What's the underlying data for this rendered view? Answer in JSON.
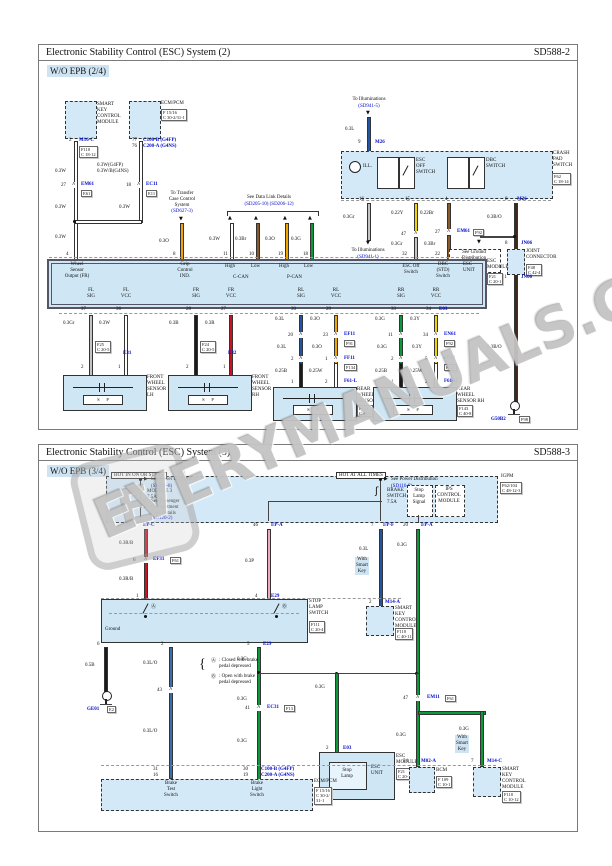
{
  "icons": {
    "fuse": "ʃ",
    "arrow_down": "▼",
    "arrow_up": "▲",
    "arrow_right": "▶",
    "chevron": "^",
    "brace": "{"
  },
  "watermark": {
    "text": "EVERYMANUALS.COM",
    "logo_letter": "E"
  },
  "colors": {
    "component_fill": "#d4e9f7",
    "module_fill": "#cfe7f5",
    "link_blue": "#0008c8",
    "wire_white": "#ffffff",
    "wire_gray": "#c4c4c4",
    "wire_black": "#1a1a1a",
    "wire_red": "#cc1122",
    "wire_blue": "#2055a8",
    "wire_blue_orange": "#3a6fae",
    "wire_green": "#0a9a3c",
    "wire_orange": "#f0a500",
    "wire_yellow": "#f2d500",
    "wire_brown": "#8a5a2a",
    "wire_dark_brown": "#40291a",
    "wire_pink": "#f2a9c4"
  },
  "p1": {
    "title": "Electronic Stability Control (ESC) System (2)",
    "code": "SD588-2",
    "variant": "W/O EPB (2/4)",
    "labels": {
      "skcm": "SMART\nKEY\nCONTROL\nMODULE",
      "ecm": "ECM/PCM",
      "ecm_ref": "F 15/16\nC 30-2/31-1",
      "pin2": "2",
      "m16c": "M16-C",
      "m16c_ref": "F110\nC 18-12",
      "pin77": "77",
      "pin76": "76",
      "c100": "C100-B (G4FP)",
      "c200": "C200-A (G4NS)",
      "w1": "0.3W",
      "w2": "0.3W(G4FP)\n0.3W/B(G4NS)",
      "pin27": "27",
      "em61": "EM61",
      "em61_ref": "E61",
      "pin18": "18",
      "ec11": "EC11",
      "ec11_ref": "E11",
      "w3": "0.3W",
      "w4": "0.3W",
      "w5": "0.3W",
      "pin4": "4",
      "transfer": "To Transfer\nCase Control\nSystem",
      "transfer_link": "(SD627-3)",
      "w6": "0.3O",
      "pin8": "8",
      "datalink": "See Data Link Details",
      "datalink_link": "(SD205-10) (SD206-12)",
      "w7": "0.3W",
      "w8": "0.3Br",
      "w9": "0.3O",
      "w10": "0.3G",
      "pin11": "11",
      "pin10": "10",
      "pin19": "19",
      "pin18b": "18",
      "ill_top": "To Illuminations",
      "ill_top_link": "(SD941-5)",
      "w11": "0.3L",
      "pin9": "9",
      "m26": "M26",
      "ill_lamp": "ILL.",
      "esc_off_switch": "ESC\nOFF\nSWITCH",
      "dbc_switch": "DBC\nSWITCH",
      "crash_pad": "CRASH\nPAD\nSWITCH",
      "crash_ref": "F62\nC 18-14",
      "pin16": "16",
      "pin15": "15",
      "pin4b": "4",
      "pin8b": "8",
      "m26b": "M26",
      "w12": "0.3Gr",
      "ill_bot": "To Illuminations",
      "ill_bot_link": "(SD941-1)",
      "w13": "0.22Y",
      "pin47": "47",
      "w14": "0.3Gr",
      "pin32": "32",
      "w15": "0.22Br",
      "pin27b": "27",
      "em61b": "EM61",
      "em61b_ref": "F92",
      "w16": "0.3Br",
      "pin22": "22",
      "e03": "E03",
      "w17": "0.3B/O",
      "w19": "0.3B/O",
      "see_gnd": "See Ground\nDistribution",
      "see_gnd_link": "(SD136-2)",
      "pin8c": "8",
      "jn06a": "JN06",
      "joint": "JOINT\nCONNECTOR",
      "joint_ref": "F48\nC 42-4",
      "pin11b": "11",
      "jn06b": "JN06",
      "g50b2": "G50B2",
      "g50b2_ref": "F98",
      "wheel_out": "Wheel\nSensor\nOutput (FR)",
      "grip": "Grip\nControl\nIND.",
      "high1": "High",
      "low1": "Low",
      "ccan": "C-CAN",
      "high2": "High",
      "low2": "Low",
      "pcan": "P-CAN",
      "esc_off": "ESC Off\nSwitch",
      "dbc_std": "DBC\n(STD)\nSwitch",
      "esc_unit": "ESC\nUNIT",
      "esc_module": "ESC\nMODULE",
      "esc_module_ref": "F21\nC 20-1",
      "fl_sig": "FL\nSIG",
      "fl_vcc": "FL\nVCC",
      "fr_sig": "FR\nSIG",
      "fr_vcc": "FR\nVCC",
      "rl_sig": "RL\nSIG",
      "rl_vcc": "RL\nVCC",
      "rr_sig": "RR\nSIG",
      "rr_vcc": "RR\nVCC",
      "p37": "37",
      "p36": "36",
      "p28": "28",
      "p27": "27",
      "p30": "30",
      "p29": "29",
      "p33": "33",
      "p34": "34",
      "e03b": "E03",
      "w20": "0.3Gr",
      "w21": "0.3W",
      "w22": "0.3B",
      "w23": "0.3R",
      "w24": "0.3L",
      "w25": "0.3O",
      "w26": "0.3G",
      "w27": "0.3Y",
      "fl_ref": "F25\nC 20-5",
      "e31": "E31",
      "fr_ref": "F24\nC 20-5",
      "e32": "E32",
      "p2a": "2",
      "p1a": "1",
      "p2b": "2",
      "p1b": "1",
      "p20": "20",
      "p23": "23",
      "ef11": "EF11",
      "ef11_ref": "F91",
      "w28": "0.3L",
      "w29": "0.3O",
      "p2c": "2",
      "p1c": "1",
      "ff11": "FF11",
      "ff11_ref": "F134",
      "w30": "0.25B",
      "w31": "0.25W",
      "p1d": "1",
      "p2d": "2",
      "f61l": "F61-L",
      "p11": "11",
      "p34b": "34",
      "en61": "EN61",
      "en61_ref": "F92",
      "w32": "0.3G",
      "w33": "0.3Y",
      "p2e": "2",
      "p5": "5",
      "ff12": "FF12",
      "ff12_ref": "F137",
      "w34": "0.25B",
      "w35": "0.25W",
      "p1e": "1",
      "p2f": "2",
      "f61r": "F61-R",
      "fl_sensor": "FRONT\nWHEEL\nSENSOR\nLH",
      "fr_sensor": "FRONT\nWHEEL\nSENSOR\nRH",
      "rl_sensor": "REAR\nWHEEL\nSENSOR LH",
      "rl_sensor_ref": "F141\nC 40-6",
      "rr_sensor": "REAR\nWHEEL\nSENSOR RH",
      "rr_sensor_ref": "F143\nC 40-8",
      "sp": "S      P"
    }
  },
  "p2": {
    "title": "Electronic Stability Control (ESC) System (3)",
    "code": "SD588-3",
    "variant": "W/O EPB (3/4)",
    "labels": {
      "hot1": "HOT IN ON OR START",
      "hot2": "HOT AT ALL TIMES",
      "spd1": "See Power Distribution",
      "spd1_link": "(SD110-8)",
      "fuse1": "MODULE 3\n7.5A",
      "spcfd": "See Passenger\nCompartment\nFuse Details",
      "spcfd_link": "(SD120-2)",
      "spd2": "See Power Distribution",
      "spd2_link": "(SD116-9)",
      "fuse2": "BRAKE\nSWITCH\n7.5A",
      "sls_sig": "Stop\nLamp\nSignal",
      "ips": "IPS\nCONTROL\nMODULE",
      "igpm": "IGPM",
      "igpm_ref": "F62/104\nC 48-12-3",
      "p13": "13",
      "ipc": "I/P-C",
      "p46": "46",
      "ipa1": "I/P-A",
      "p7": "7",
      "ipf": "I/P-F",
      "p20": "20",
      "ipa2": "I/P-A",
      "w1": "0.3R/B",
      "p6c": "6",
      "ef31": "EF31",
      "ef31_ref": "F61",
      "w2": "0.3R/B",
      "p1": "1",
      "w3": "0.3P",
      "p4": "4",
      "e29a": "E29",
      "w4": "0.3L",
      "smart1": "With\nSmart\nKey",
      "p2a": "2",
      "m14a": "M14-A",
      "skcm1": "SMART\nKEY\nCONTROL\nMODULE",
      "skcm1_ref": "F110\nC 40-11",
      "w5": "0.3G",
      "ground": "Ground",
      "sw_a": "Ⓐ",
      "sw_b": "Ⓑ",
      "sls": "STOP\nLAMP\nSWITCH",
      "sls_ref": "F111\nC 20-4",
      "p6": "6",
      "w6": "0.5B",
      "ge01": "GE01",
      "ge01_ref": "E2",
      "p2b": "2",
      "w7": "0.3L/O",
      "p43": "43",
      "w8": "0.3L/O",
      "p31": "31",
      "p16": "16",
      "p5": "5",
      "e29b": "E29",
      "w9": "0.3G",
      "w10": "0.3G",
      "p41": "41",
      "ec31": "EC31",
      "ec31_ref": "F13",
      "w11": "0.3G",
      "p30": "30",
      "p19": "19",
      "c100": "C100-B (G4FP)",
      "c200": "C200-A (G4NS)",
      "note_a": "Ⓐ",
      "note_a_txt": ": Closed with brake\npedal depressed",
      "note_b": "Ⓑ",
      "note_b_txt": ": Open with brake\npedal depressed",
      "w12": "0.3G",
      "p2c": "2",
      "e03": "E03",
      "stop_lamp": "Stop\nLamp",
      "esc_unit": "ESC\nUNIT",
      "esc_module": "ESC\nMODULE",
      "esc_module_ref": "F21\nC 20-1",
      "brake_test": "Brake\nTest\nSwitch",
      "brake_light": "Brake\nLight\nSwitch",
      "ecm": "ECM/PCM",
      "ecm_ref": "F 15/16\nC 30-2/\n31-1",
      "p47": "47",
      "em11": "EM11",
      "em11_ref": "F61",
      "w13": "0.3G",
      "w14": "0.3G",
      "smart2": "With\nSmart\nKey",
      "p54": "54",
      "m02a": "M02-A",
      "bcm": "BCM",
      "bcm_ref": "F 109\nC 10-1",
      "p7b": "7",
      "m14c": "M14-C",
      "skcm2": "SMART\nKEY\nCONTROL\nMODULE",
      "skcm2_ref": "F110\nC 10-12"
    }
  }
}
